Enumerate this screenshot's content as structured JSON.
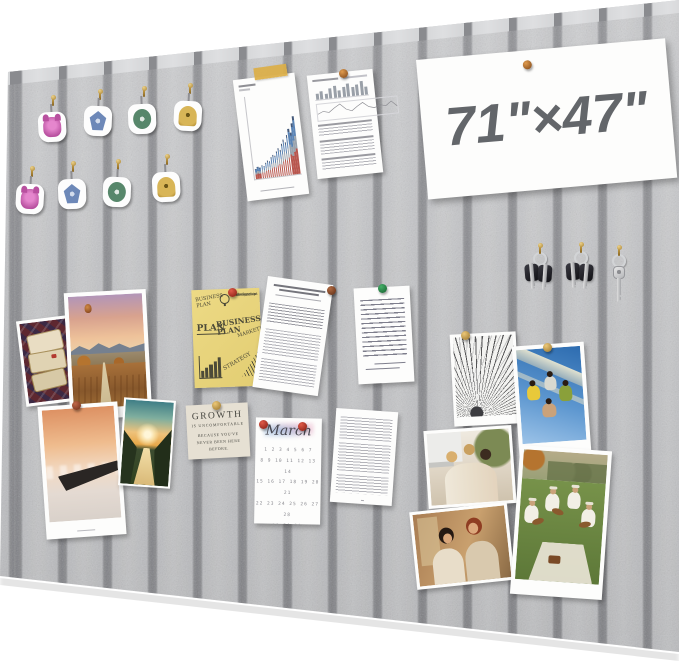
{
  "product": {
    "dimension_label": "71\"×47\"",
    "growth_card": {
      "line1": "GROWTH",
      "line2": "IS UNCOMFORTABLE",
      "line3": "BECAUSE YOU'VE NEVER BEEN HERE BEFORE."
    },
    "calendar": {
      "title": "March",
      "weeks": [
        "1 2 3 4 5 6 7",
        "8 9 10 11 12 13 14",
        "15 16 17 18 19 20 21",
        "22 23 24 25 26 27 28",
        "29 30 31"
      ]
    },
    "plan_note": {
      "heading": "BUSINESS PLAN",
      "list": [
        "Time",
        "Relationship",
        "Development",
        "Management"
      ],
      "plan": "PLAN",
      "center": "BUSINESS PLAN",
      "marketing": "MARKETING",
      "strategy": "STRATEGY"
    },
    "colors": {
      "felt_panel": "#c7c8ca",
      "felt_groove": "#8e8f93",
      "board_edge": "#d8d9db",
      "tape": "#dcae47",
      "note_yellow": "#e8d47c",
      "bar_red": "#b8564e",
      "bar_gray": "#9aa3ad",
      "bar_blue": "#5b84b5",
      "pin_brass": "#c99b4a",
      "pin_red": "#c0392b",
      "pin_green": "#2e8b57",
      "pin_bronze": "#c8742a"
    },
    "bar_chart": {
      "bars": [
        12,
        14,
        13,
        16,
        15,
        18,
        21,
        19,
        24,
        27,
        25,
        30,
        34,
        31,
        38,
        43,
        40,
        48,
        55,
        51,
        62,
        70
      ]
    },
    "analytics": {
      "mini_bars": [
        40,
        55,
        35,
        65,
        80,
        50,
        70,
        90,
        60,
        75,
        95,
        55
      ],
      "sparkline": [
        6,
        9,
        7,
        12,
        16,
        9,
        6,
        11,
        15,
        9,
        7,
        10,
        8,
        13,
        6
      ]
    }
  }
}
